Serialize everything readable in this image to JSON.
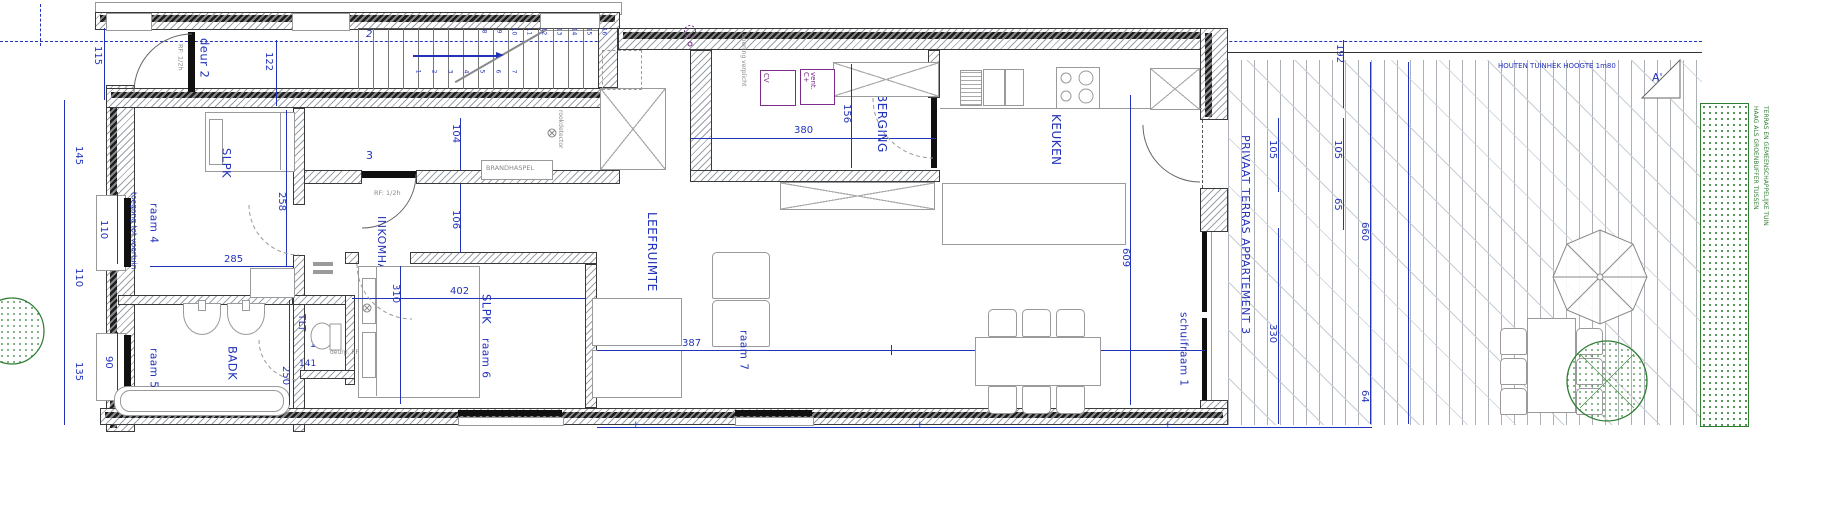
{
  "rooms": {
    "slpk1": "SLPK",
    "badk": "BADK",
    "tlt": "TLT",
    "inkomhal": "INKOMHAL",
    "slpk2": "SLPK",
    "leefruimte": "LEEFRUIMTE",
    "berging": "BERGING",
    "keuken": "KEUKEN",
    "terras": "PRIVAAT TERRAS APPARTEMENT 3"
  },
  "openings": {
    "deur2": "deur 2",
    "deur3": "deur 3",
    "voordeur": "3",
    "trap": "2",
    "raam4": "raam 4",
    "raam5": "raam 5",
    "raam6": "raam 6",
    "raam7": "raam 7",
    "schuifraam1": "schuifraam 1"
  },
  "dims": {
    "d115": "115",
    "d122": "122",
    "d145": "145",
    "d110a": "110",
    "d110b": "110",
    "d135": "135",
    "d90": "90",
    "d285": "285",
    "d258": "258",
    "d250": "250",
    "d104": "104",
    "d106": "106",
    "d120": "120",
    "d141": "141",
    "d310": "310",
    "d402": "402",
    "d380": "380",
    "d156": "156",
    "d387": "387",
    "d400": "400",
    "d609": "609",
    "d192": "192",
    "d105a": "105",
    "d105b": "105",
    "d65": "65",
    "d660": "660",
    "d330": "330",
    "d64": "64"
  },
  "annotations": {
    "rf_deur2": "RF: 1/2h",
    "rf_voordeur": "RF: 1/2h",
    "brandhaspel": "BRANDHASPEL",
    "rookdetector1": "rookdetector",
    "rookdetector2": "rookdetector",
    "toegang": "toegang tot voortuin",
    "deurp": "deurp. RF 1/2h",
    "verplicht": "opening verplicht",
    "cv": "CV",
    "vent": "vent. C+",
    "tuinhek": "HOUTEN TUINHEK HOOGTE 1m80",
    "haag1": "HAAG ALS GROENBUFFER TUSSEN",
    "haag2": "TERRAS EN GEMEENSCHAPPELIJKE TUIN",
    "section": "A'"
  },
  "stairs": {
    "bottom": [
      "1",
      "2",
      "3",
      "4",
      "5",
      "6",
      "7"
    ],
    "top": [
      "8",
      "9",
      "10",
      "11",
      "12",
      "13",
      "14",
      "15",
      "16"
    ]
  },
  "colors": {
    "dimension_blue": "#2233bb",
    "wall_dark": "#1e1e1e",
    "hatch_gray": "#98a0a8",
    "installation_purple": "#7a2d8b",
    "vegetation_green": "#2e7d32"
  }
}
